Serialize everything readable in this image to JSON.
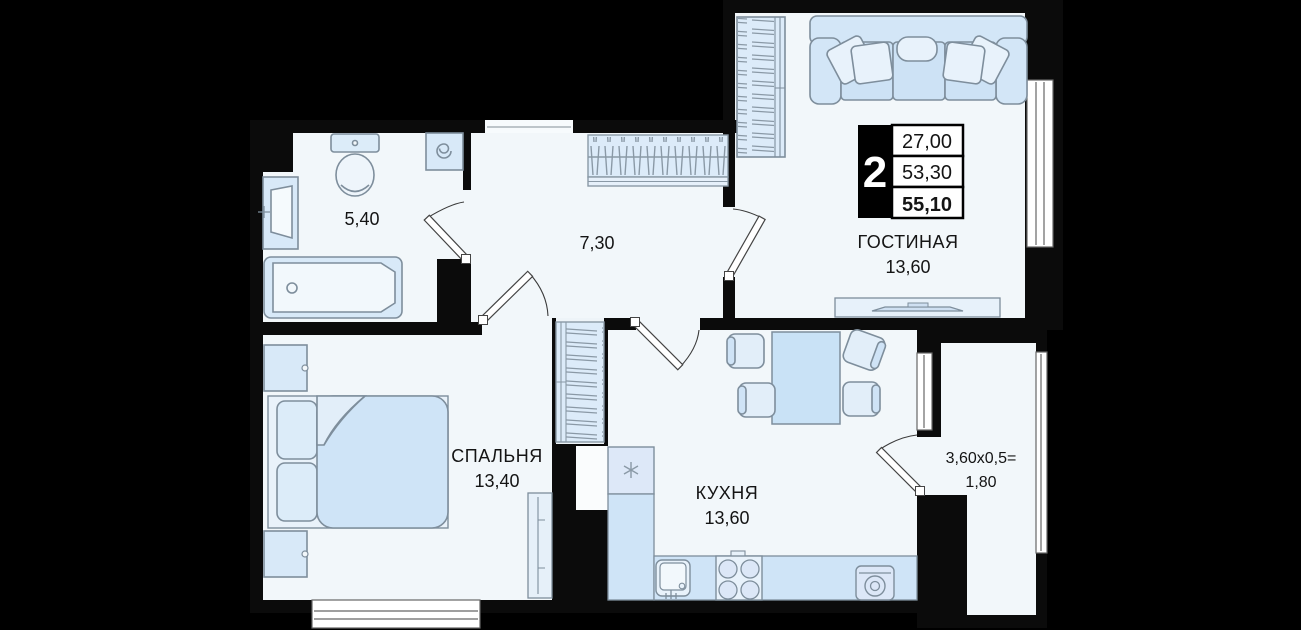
{
  "info_box": {
    "rooms_count": "2",
    "area_living": "27,00",
    "area_apartment": "53,30",
    "area_total": "55,10"
  },
  "rooms": {
    "living": {
      "name": "ГОСТИНАЯ",
      "area": "13,60"
    },
    "bedroom": {
      "name": "СПАЛЬНЯ",
      "area": "13,40"
    },
    "kitchen": {
      "name": "КУХНЯ",
      "area": "13,60"
    },
    "bathroom": {
      "area": "5,40"
    },
    "hallway": {
      "area": "7,30"
    },
    "balcony": {
      "formula": "3,60x0,5=",
      "area": "1,80"
    }
  },
  "colors": {
    "background": "#000000",
    "walls": "#0b0b0b",
    "floor": "#f2f7fa",
    "furniture": "#d8e9f8",
    "furniture_light": "#e8f2fb",
    "counter": "#cfe4f7",
    "outline": "#7e8e9c",
    "window_frame": "#666666",
    "text": "#141414"
  }
}
